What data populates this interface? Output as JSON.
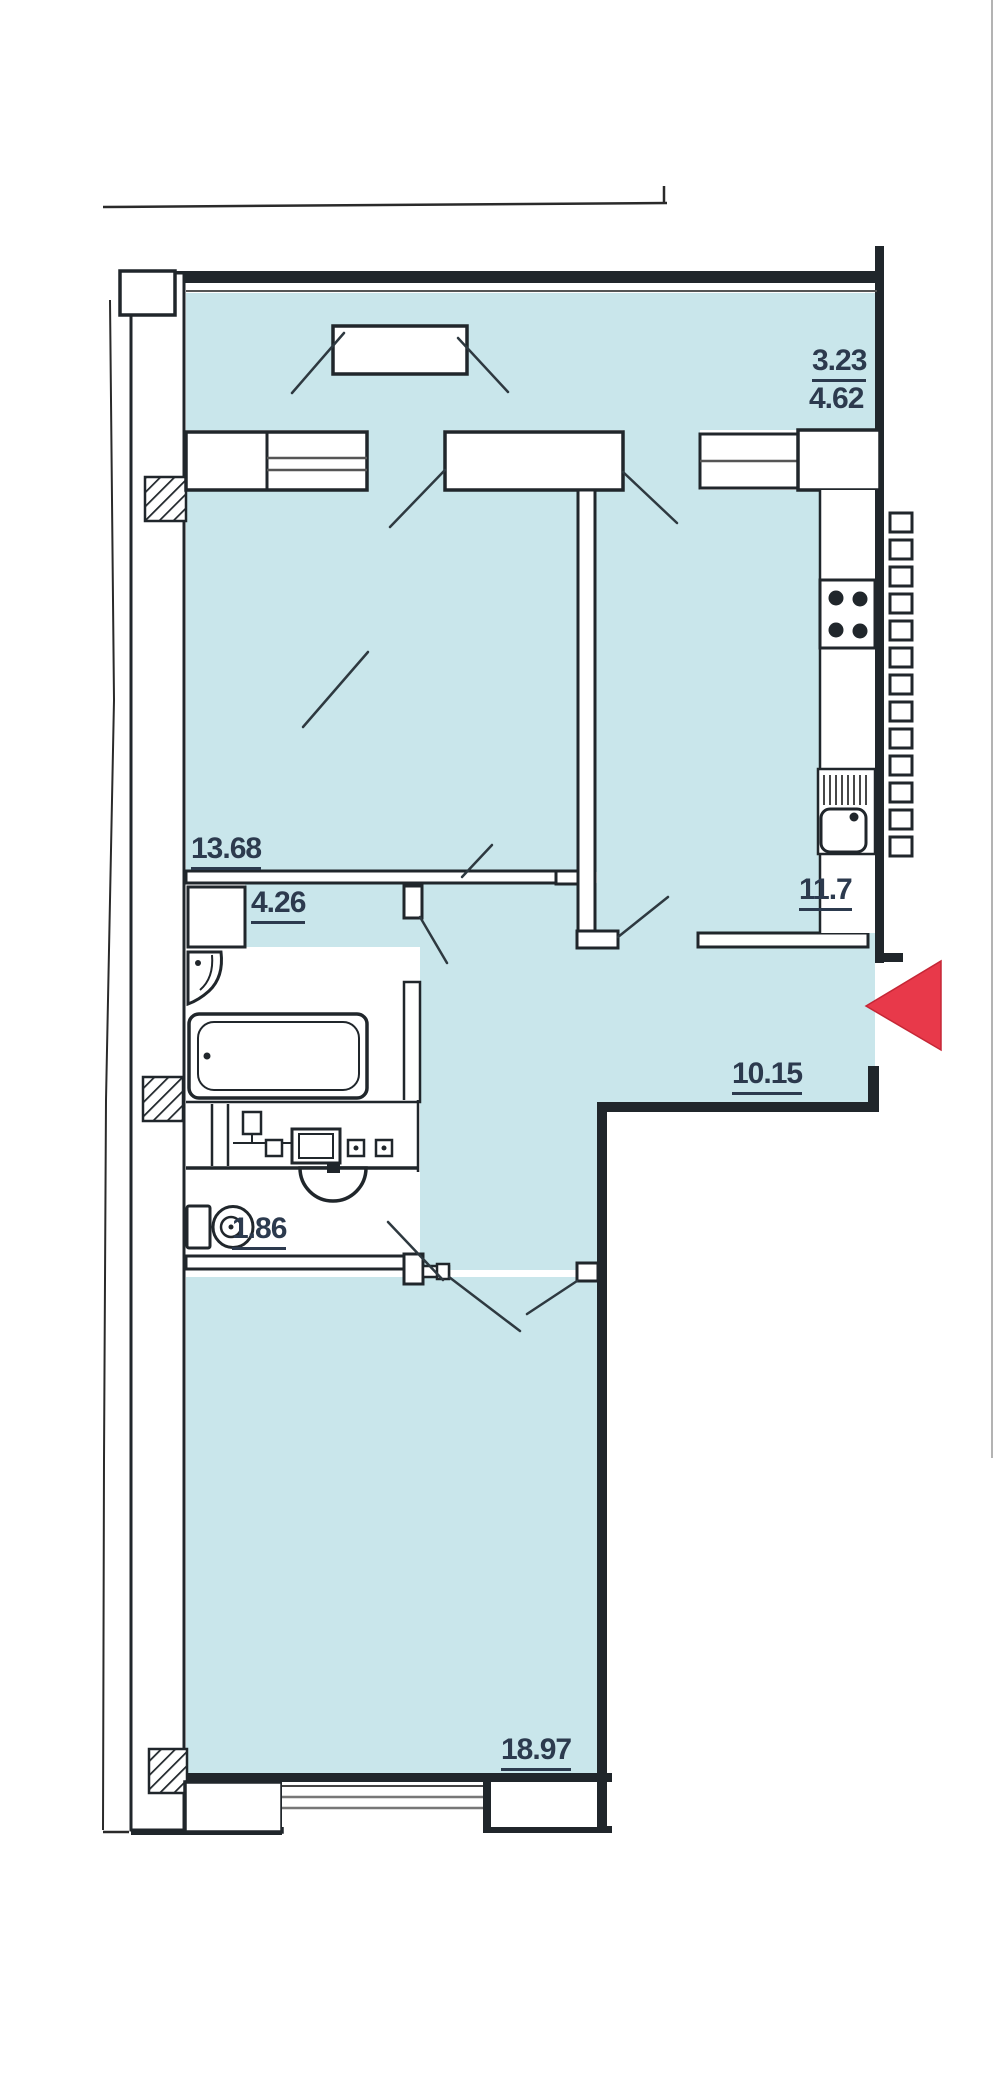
{
  "document": {
    "kind": "apartment floor plan (scanned drawing)",
    "floor_fill": "#c9e6eb",
    "wall_color": "#20262b",
    "label_color": "#2c3a4e",
    "arrow_color": "#e8394a"
  },
  "rooms": [
    {
      "id": "loggia",
      "area_reduced": "3.23",
      "area": "4.62"
    },
    {
      "id": "living-room",
      "area": "13.68"
    },
    {
      "id": "hallway",
      "area": "4.26"
    },
    {
      "id": "kitchen",
      "area": "11.7"
    },
    {
      "id": "corridor",
      "area": "10.15"
    },
    {
      "id": "wc",
      "area": "1.86"
    },
    {
      "id": "bedroom",
      "area": "18.97"
    }
  ],
  "fixtures": [
    "bathtub",
    "wash-basin",
    "toilet",
    "semicircular-basin",
    "laundry-counter",
    "kitchen-counter",
    "kitchen-stove",
    "kitchen-sink",
    "exterior-ladder"
  ],
  "entrance": {
    "marker": "red triangle",
    "direction": "left"
  }
}
